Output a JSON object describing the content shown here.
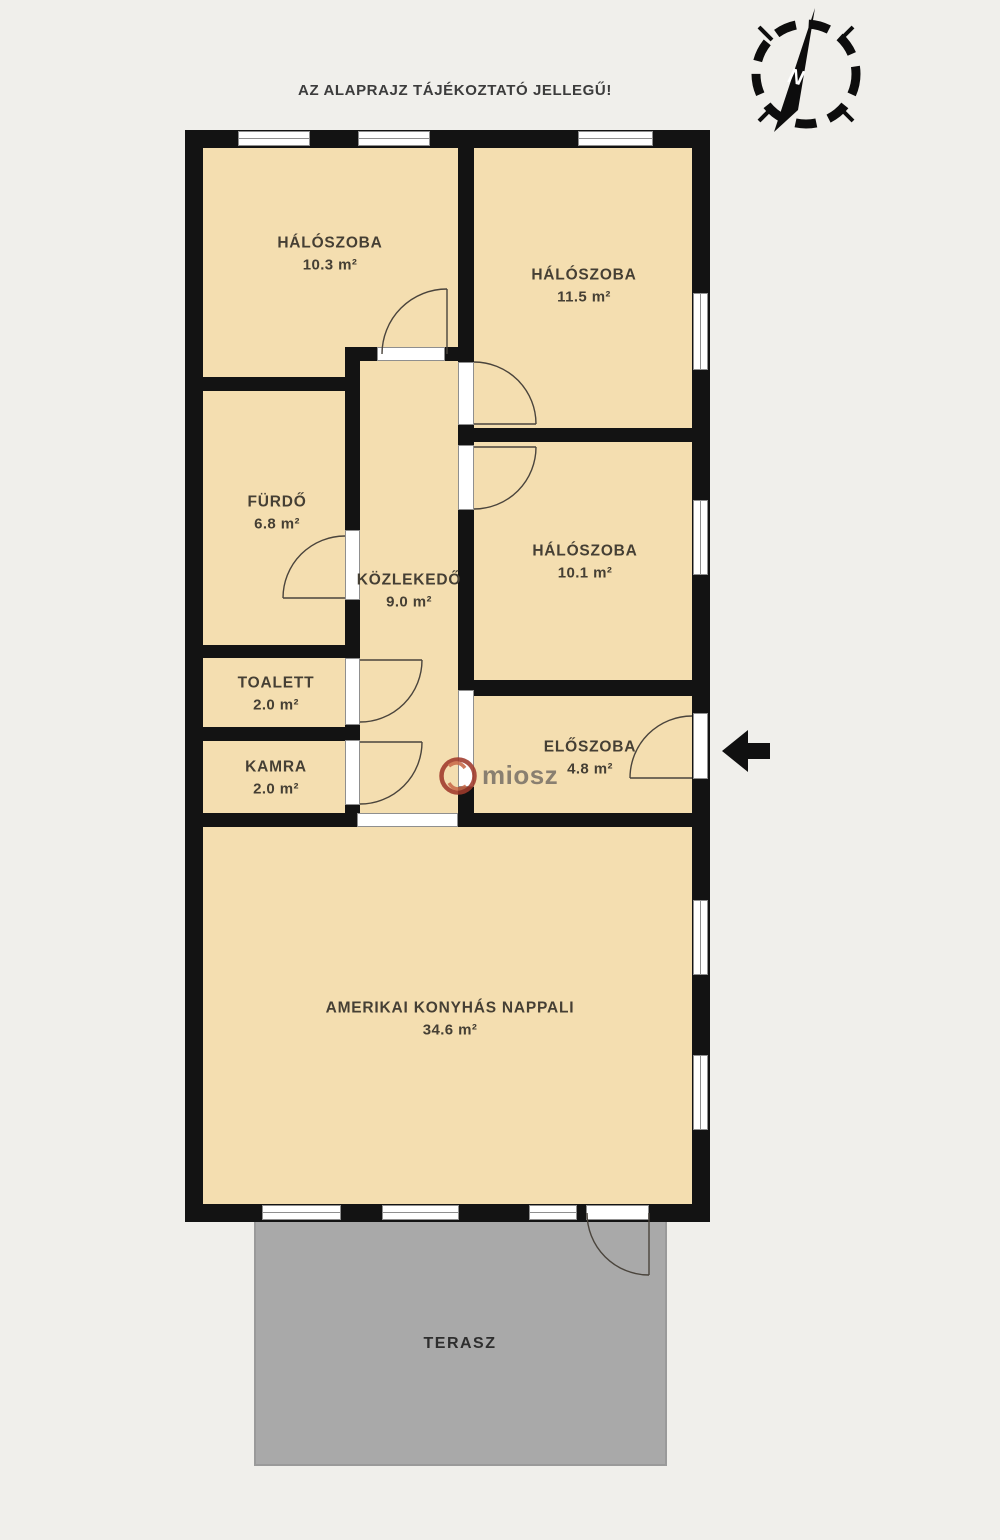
{
  "disclaimer": "AZ ALAPRAJZ TÁJÉKOZTATÓ JELLEGŰ!",
  "compass": {
    "label": "N"
  },
  "watermark": {
    "text": "miosz"
  },
  "icons": {
    "compass": "north-compass",
    "entrance_arrow": "left-arrow"
  },
  "colors": {
    "background": "#f0efeb",
    "room_fill": "#f4deb0",
    "wall": "#131313",
    "terrace_fill": "#a9a9a9",
    "terrace_border": "#9a9a9a",
    "label_text": "#453f34",
    "frame": "#8f8f8f",
    "logo_red": "#a03a2c",
    "logo_text": "#80786b"
  },
  "rooms": [
    {
      "name": "HÁLÓSZOBA",
      "area": "10.3 m²"
    },
    {
      "name": "HÁLÓSZOBA",
      "area": "11.5 m²"
    },
    {
      "name": "FÜRDŐ",
      "area": "6.8 m²"
    },
    {
      "name": "KÖZLEKEDŐ",
      "area": "9.0 m²"
    },
    {
      "name": "HÁLÓSZOBA",
      "area": "10.1 m²"
    },
    {
      "name": "TOALETT",
      "area": "2.0 m²"
    },
    {
      "name": "KAMRA",
      "area": "2.0 m²"
    },
    {
      "name": "ELŐSZOBA",
      "area": "4.8 m²"
    },
    {
      "name": "AMERIKAI KONYHÁS NAPPALI",
      "area": "34.6 m²"
    },
    {
      "name": "TERASZ"
    }
  ]
}
